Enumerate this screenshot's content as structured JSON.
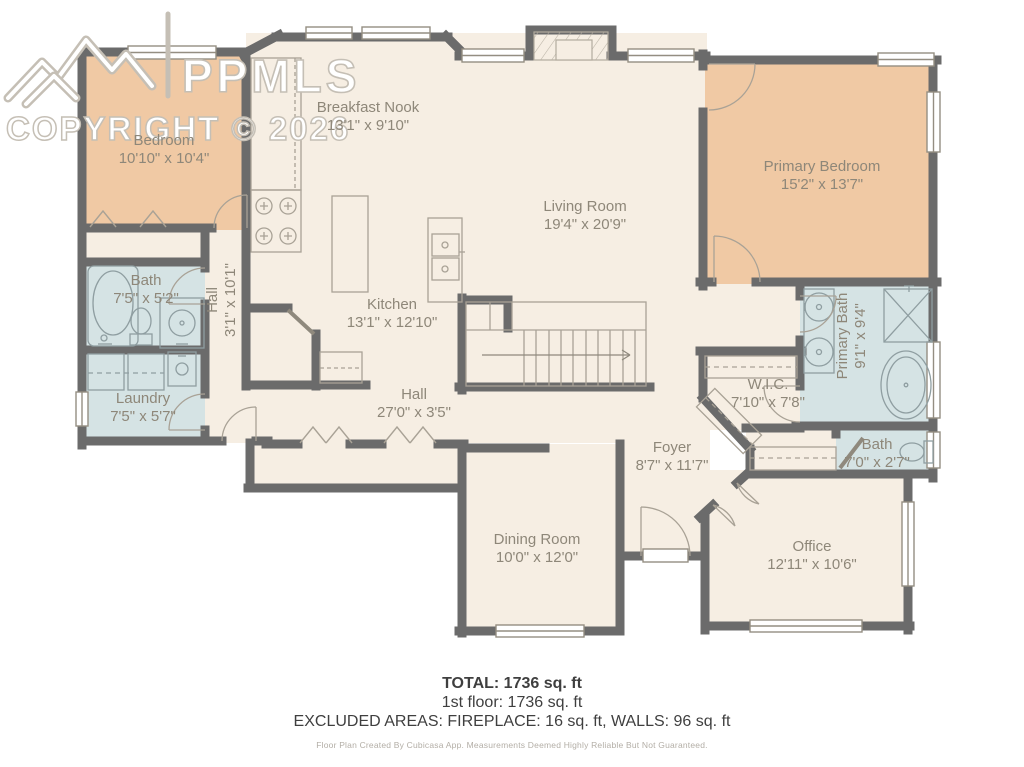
{
  "watermark": {
    "logo_text": "PPMLS",
    "copyright": "COPYRIGHT © 2026"
  },
  "rooms": {
    "bedroom": {
      "name": "Bedroom",
      "dims": "10'10\" x 10'4\""
    },
    "breakfast_nook": {
      "name": "Breakfast Nook",
      "dims": "13'1\" x 9'10\""
    },
    "kitchen": {
      "name": "Kitchen",
      "dims": "13'1\" x 12'10\""
    },
    "living_room": {
      "name": "Living Room",
      "dims": "19'4\" x 20'9\""
    },
    "primary_bedroom": {
      "name": "Primary Bedroom",
      "dims": "15'2\" x 13'7\""
    },
    "bath": {
      "name": "Bath",
      "dims": "7'5\" x 5'2\""
    },
    "hall_vertical": {
      "name": "Hall",
      "dims": "3'1\" x 10'1\""
    },
    "laundry": {
      "name": "Laundry",
      "dims": "7'5\" x 5'7\""
    },
    "hall": {
      "name": "Hall",
      "dims": "27'0\" x 3'5\""
    },
    "wic": {
      "name": "W.I.C.",
      "dims": "7'10\" x 7'8\""
    },
    "primary_bath": {
      "name": "Primary Bath",
      "dims": "9'1\" x 9'4\""
    },
    "bath_small": {
      "name": "Bath",
      "dims": "7'0\" x 2'7\""
    },
    "foyer": {
      "name": "Foyer",
      "dims": "8'7\" x 11'7\""
    },
    "dining_room": {
      "name": "Dining Room",
      "dims": "10'0\" x 12'0\""
    },
    "office": {
      "name": "Office",
      "dims": "12'11\" x 10'6\""
    }
  },
  "summary": {
    "total": "TOTAL: 1736 sq. ft",
    "first_floor": "1st floor: 1736 sq. ft",
    "excluded": "EXCLUDED AREAS: FIREPLACE: 16 sq. ft, WALLS: 96 sq. ft"
  },
  "footer": {
    "disclaimer": "Floor Plan Created By Cubicasa App. Measurements Deemed Highly Reliable But Not Guaranteed."
  },
  "colors": {
    "floor": "#f6eee3",
    "bedroom_fill": "#f0c9a4",
    "wet_fill": "#d5e3e4",
    "wall": "#6b6b6b",
    "label_text": "#8e8779"
  }
}
